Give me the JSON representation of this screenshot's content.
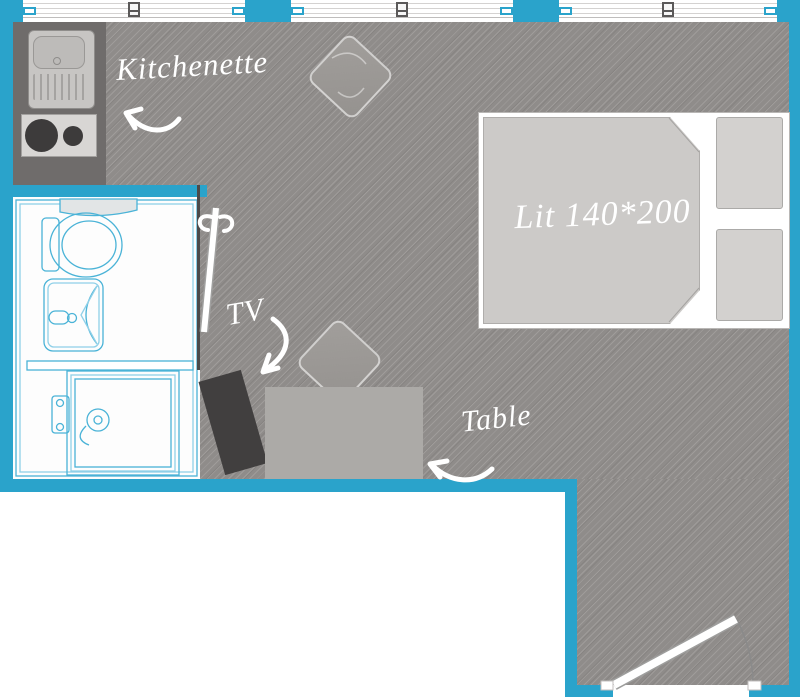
{
  "floor_plan": {
    "labels": {
      "kitchenette": "Kitchenette",
      "bed": "Lit 140*200",
      "tv": "TV",
      "table": "Table"
    },
    "colors": {
      "wall": "#2aa3cb",
      "floor": "#8f8c8a",
      "kitchen_counter": "#6f6c6b",
      "sanitary_outline": "#4ab3d7",
      "tv": "#413f3f",
      "table": "#acaaa7",
      "label_text": "#ffffff"
    }
  }
}
